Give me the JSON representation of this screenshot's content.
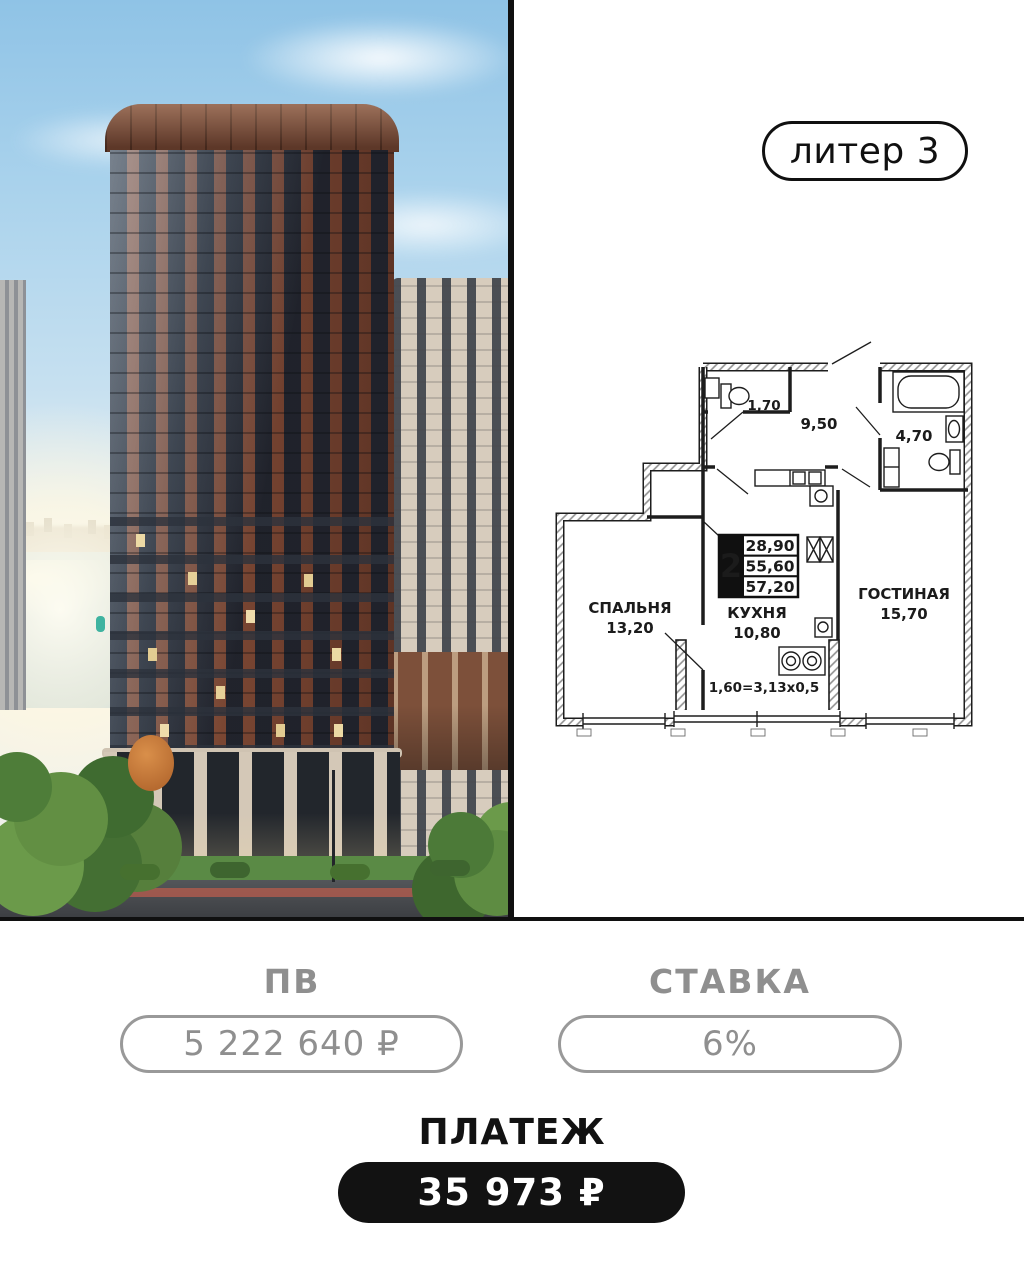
{
  "badge": {
    "label": "литер 3"
  },
  "photo": {
    "alt": "brick residential tower by the river"
  },
  "floorplan": {
    "rooms": [
      {
        "name": "СПАЛЬНЯ",
        "area": "13,20"
      },
      {
        "name": "КУХНЯ",
        "area": "10,80"
      },
      {
        "name": "ГОСТИНАЯ",
        "area": "15,70"
      }
    ],
    "small_areas": {
      "wc": "1,70",
      "hall": "9,50",
      "bath": "4,70"
    },
    "info_box": {
      "rooms": "2",
      "areas": [
        "28,90",
        "55,60",
        "57,20"
      ]
    },
    "balcony_note": "1,60=3,13x0,5"
  },
  "metrics": {
    "pv": {
      "label": "ПВ",
      "value": "5 222 640 ₽"
    },
    "rate": {
      "label": "СТАВКА",
      "value": "6%"
    },
    "payment": {
      "label": "ПЛАТЕЖ",
      "value": "35 973 ₽"
    }
  },
  "colors": {
    "accent_black": "#101010",
    "muted_gray": "#8f8f8f"
  }
}
